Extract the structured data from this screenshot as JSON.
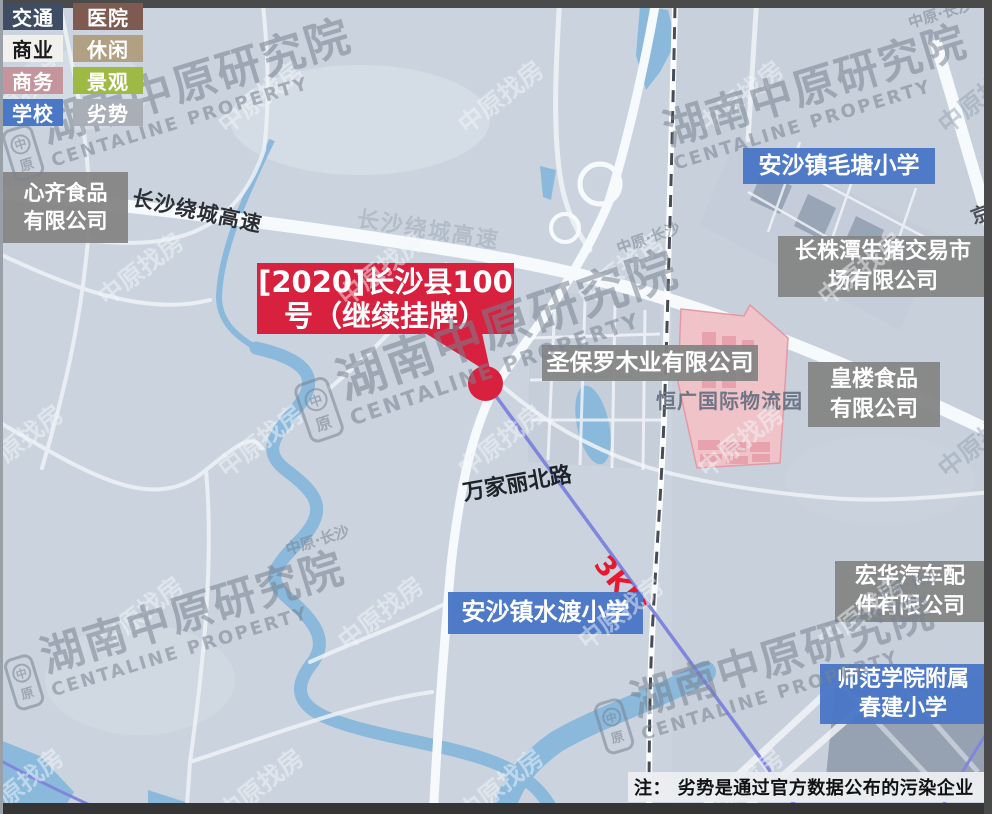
{
  "legend": {
    "items": [
      {
        "label": "交通",
        "bg": "#3e4d63",
        "fg": "#ffffff"
      },
      {
        "label": "医院",
        "bg": "#7e5a50",
        "fg": "#ffffff"
      },
      {
        "label": "商业",
        "bg": "#f1f0ed",
        "fg": "#1a1a1a"
      },
      {
        "label": "休闲",
        "bg": "#b2a084",
        "fg": "#ffffff"
      },
      {
        "label": "商务",
        "bg": "#c6949b",
        "fg": "#ffffff"
      },
      {
        "label": "景观",
        "bg": "#9eba45",
        "fg": "#ffffff"
      },
      {
        "label": "学校",
        "bg": "#4a77c6",
        "fg": "#ffffff"
      },
      {
        "label": "劣势",
        "bg": "#a9aeb7",
        "fg": "#ffffff"
      }
    ]
  },
  "callout": {
    "line1": "[2020]长沙县100",
    "line2": "号（继续挂牌）",
    "color": "#d8213e"
  },
  "poi": {
    "xinqi": {
      "line1": "心齐食品",
      "line2": "有限公司"
    },
    "shengbaoluo": {
      "line1": "圣保罗木业有限公司"
    },
    "maotang": {
      "line1": "安沙镇毛塘小学"
    },
    "changzhutan": {
      "line1": "长株潭生猪交易市",
      "line2": "场有限公司"
    },
    "huanglou": {
      "line1": "皇楼食品",
      "line2": "有限公司"
    },
    "honghua": {
      "line1": "宏华汽车配",
      "line2": "件有限公司"
    },
    "shifan": {
      "line1": "师范学院附属",
      "line2": "春建小学"
    },
    "shuidu": {
      "line1": "安沙镇水渡小学"
    }
  },
  "roads": {
    "ring_expressway_1": "长沙绕城高速",
    "ring_expressway_2": "长沙绕城高速",
    "wanjiali": "万家丽北路",
    "jinggangao": "京港澳"
  },
  "map_texts": {
    "logistics_park": "恒广国际物流园",
    "distance_label": "3KM"
  },
  "note": {
    "text": "注： 劣势是通过官方数据公布的污染企业"
  },
  "watermark": {
    "brand_cn": "湖南中原研究院",
    "brand_en": "CENTALINE PROPERTY",
    "brand_sub": "中原·长沙",
    "logo_top": "中",
    "logo_bottom": "原",
    "tile": "中原找房"
  },
  "colors": {
    "school_blue": "#4a77c6",
    "poi_gray": "#858585",
    "marker_red": "#d8213e",
    "distance_red": "#e8182e",
    "radius_line_purple": "#8186dd"
  }
}
